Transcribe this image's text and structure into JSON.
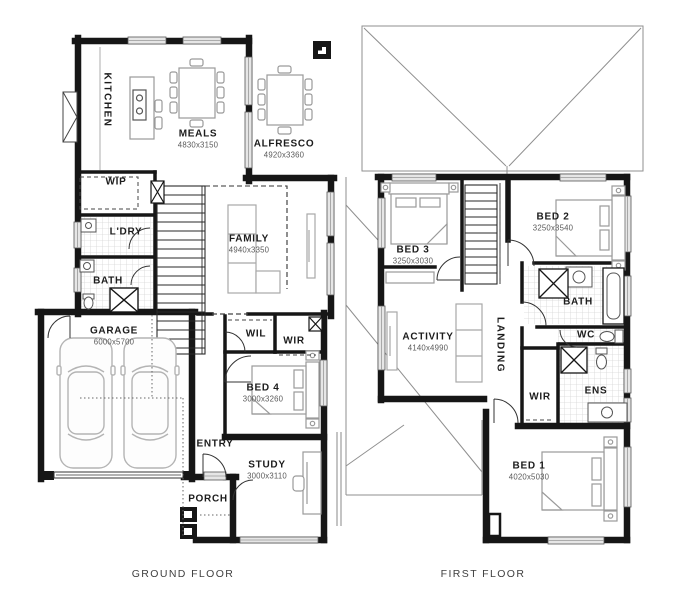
{
  "page": {
    "background": "#ffffff",
    "wall_color": "#161616",
    "window_color": "#e6e6e6",
    "furniture_color": "#ababab"
  },
  "marker_icon": "plan-corner-marker",
  "floors": [
    {
      "caption": "GROUND FLOOR",
      "rooms": [
        {
          "name": "KITCHEN",
          "dims": ""
        },
        {
          "name": "MEALS",
          "dims": "4830x3150"
        },
        {
          "name": "ALFRESCO",
          "dims": "4920x3360"
        },
        {
          "name": "WIP",
          "dims": ""
        },
        {
          "name": "L'DRY",
          "dims": ""
        },
        {
          "name": "BATH",
          "dims": ""
        },
        {
          "name": "FAMILY",
          "dims": "4940x3350"
        },
        {
          "name": "GARAGE",
          "dims": "6000x5700"
        },
        {
          "name": "WIL",
          "dims": ""
        },
        {
          "name": "WIR",
          "dims": ""
        },
        {
          "name": "BED 4",
          "dims": "3000x3260"
        },
        {
          "name": "ENTRY",
          "dims": ""
        },
        {
          "name": "STUDY",
          "dims": "3000x3110"
        },
        {
          "name": "PORCH",
          "dims": ""
        }
      ]
    },
    {
      "caption": "FIRST FLOOR",
      "rooms": [
        {
          "name": "BED 3",
          "dims": "3250x3030"
        },
        {
          "name": "BED 2",
          "dims": "3250x3540"
        },
        {
          "name": "BATH",
          "dims": ""
        },
        {
          "name": "ACTIVITY",
          "dims": "4140x4990"
        },
        {
          "name": "LANDING",
          "dims": ""
        },
        {
          "name": "WC",
          "dims": ""
        },
        {
          "name": "WIR",
          "dims": ""
        },
        {
          "name": "ENS",
          "dims": ""
        },
        {
          "name": "BED 1",
          "dims": "4020x5030"
        }
      ]
    }
  ]
}
